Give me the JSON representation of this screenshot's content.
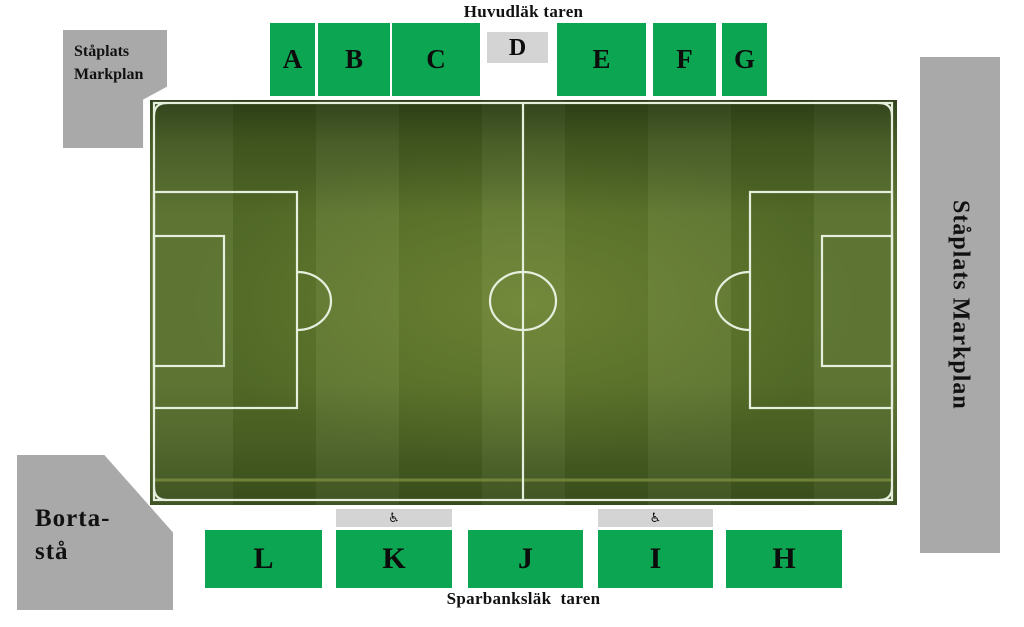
{
  "stadium": {
    "top_stand_label": "Huvudläk taren",
    "bottom_stand_label": "Sparbanksläk  taren"
  },
  "sections": {
    "top": [
      {
        "label": "A"
      },
      {
        "label": "B"
      },
      {
        "label": "C"
      },
      {
        "label": "D",
        "style": "gray"
      },
      {
        "label": "E"
      },
      {
        "label": "F"
      },
      {
        "label": "G"
      }
    ],
    "bottom": [
      {
        "label": "L"
      },
      {
        "label": "K"
      },
      {
        "label": "J"
      },
      {
        "label": "I"
      },
      {
        "label": "H"
      }
    ]
  },
  "standing_areas": {
    "home_corner": {
      "line1": "Ståplats",
      "line2": "Markplan"
    },
    "right_side": {
      "label": "Ståplats Markplan"
    },
    "away_corner": {
      "line1": "Borta-",
      "line2": "stå"
    }
  },
  "icons": {
    "wheelchair": {
      "name": "wheelchair-icon",
      "glyph": "♿"
    }
  },
  "colors": {
    "section_green": "#0ca551",
    "standing_gray": "#a9a9a9",
    "accessible_gray": "#d4d4d4",
    "pitch_green": "#546d28",
    "pitch_line": "#e6eedd",
    "text": "#111111"
  }
}
